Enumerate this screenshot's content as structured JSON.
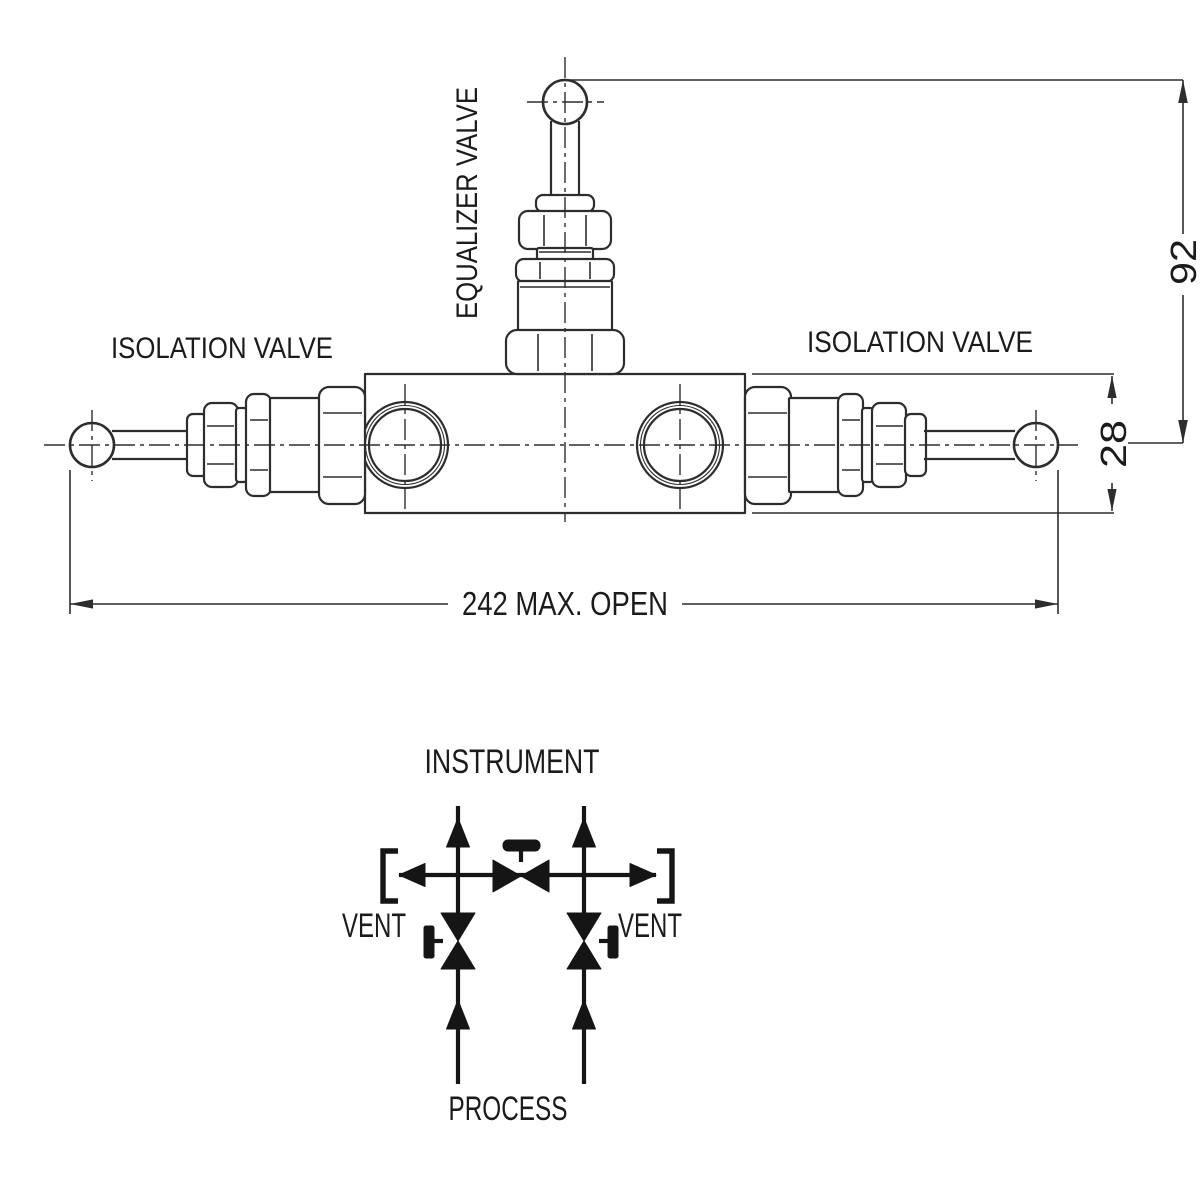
{
  "drawing": {
    "isolation_valve_left": "ISOLATION VALVE",
    "isolation_valve_right": "ISOLATION VALVE",
    "equalizer_valve": "EQUALIZER VALVE",
    "dim_handle_height": "92",
    "dim_body_height": "28",
    "dim_max_open": "242 MAX. OPEN"
  },
  "schematic": {
    "instrument": "INSTRUMENT",
    "vent_left": "VENT",
    "vent_right": "VENT",
    "process": "PROCESS"
  },
  "colors": {
    "line": "#2d2d2d",
    "schematic": "#151515",
    "text": "#1b1b1b",
    "background": "#ffffff"
  }
}
